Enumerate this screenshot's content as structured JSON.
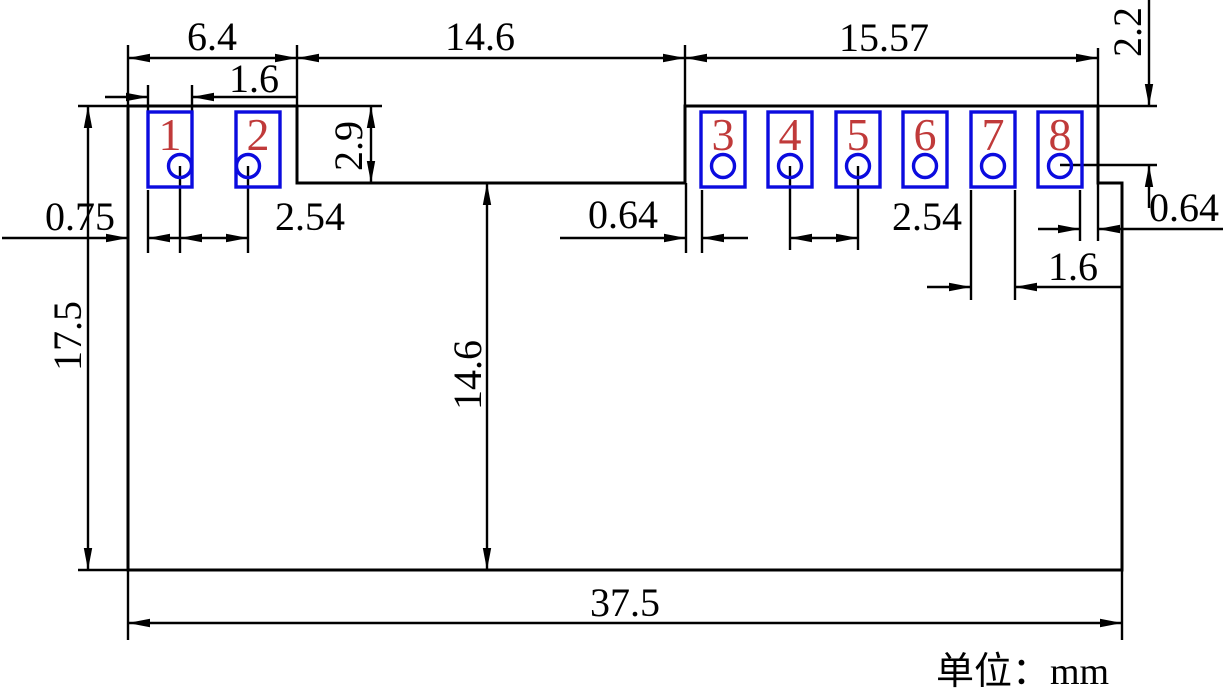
{
  "drawing": {
    "title": "module-footprint-dimension-drawing",
    "unit_note": "单位：mm",
    "pads": [
      {
        "number": "1"
      },
      {
        "number": "2"
      },
      {
        "number": "3"
      },
      {
        "number": "4"
      },
      {
        "number": "5"
      },
      {
        "number": "6"
      },
      {
        "number": "7"
      },
      {
        "number": "8"
      }
    ],
    "dims": {
      "top_left_width": "6.4",
      "notch_width": "14.6",
      "top_right_width": "15.57",
      "pin_row_from_top": "2.2",
      "pad_width_left": "1.6",
      "notch_depth": "2.9",
      "edge_to_pad": "0.75",
      "pitch_left": "2.54",
      "gap_notch_to_pad3": "0.64",
      "pitch_right": "2.54",
      "gap_pad8_to_edge": "0.64",
      "pad_width_right": "1.6",
      "body_height": "17.5",
      "notch_to_bottom": "14.6",
      "body_width": "37.5"
    },
    "colors": {
      "outline": "#000000",
      "pad": "#0b0bdf",
      "pad_number": "#c03a3a"
    }
  }
}
